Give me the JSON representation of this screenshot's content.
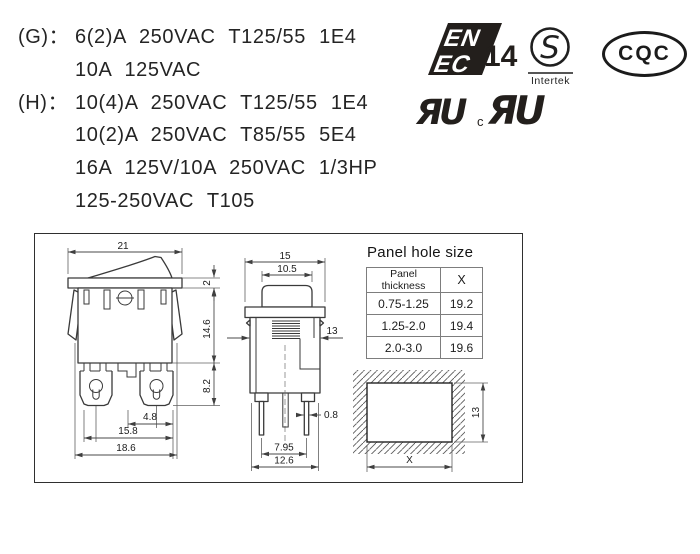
{
  "ratings": {
    "rows": [
      {
        "label": "(G)：",
        "text": "6(2)A 250VAC T125/55 1E4"
      },
      {
        "label": "",
        "text": "10A 125VAC"
      },
      {
        "label": "(H)：",
        "text": "10(4)A 250VAC T125/55 1E4"
      },
      {
        "label": "",
        "text": "10(2)A 250VAC T85/55 5E4"
      },
      {
        "label": "",
        "text": "16A 125V/10A 250VAC 1/3HP"
      },
      {
        "label": "",
        "text": "125-250VAC T105"
      }
    ]
  },
  "certifications": {
    "enec": {
      "top": "EN",
      "bottom": "EC",
      "number": "14"
    },
    "intertek": {
      "letter": "S",
      "name": "Intertek"
    },
    "cqc": {
      "text": "CQC"
    },
    "ul": {
      "mark_us": "ЯU",
      "c_prefix": "c",
      "mark_canada": "ЯU"
    }
  },
  "panel_table": {
    "title": "Panel hole size",
    "headers": [
      "Panel thickness",
      "X"
    ],
    "rows": [
      [
        "0.75-1.25",
        "19.2"
      ],
      [
        "1.25-2.0",
        "19.4"
      ],
      [
        "2.0-3.0",
        "19.6"
      ]
    ]
  },
  "front_view": {
    "dims": {
      "top_width": "21",
      "flange_thickness": "2",
      "body_height": "14.6",
      "terminal_height": "8.2",
      "terminal_pitch": "4.8",
      "inner_width": "15.8",
      "overall_width": "18.6"
    }
  },
  "side_view": {
    "dims": {
      "top_width": "15",
      "rocker_width": "10.5",
      "snap_width": "13",
      "pin_thickness": "0.8",
      "pin_pitch": "7.95",
      "overall_width": "12.6"
    }
  },
  "cutout_view": {
    "width_label": "X",
    "height_label": "13"
  }
}
